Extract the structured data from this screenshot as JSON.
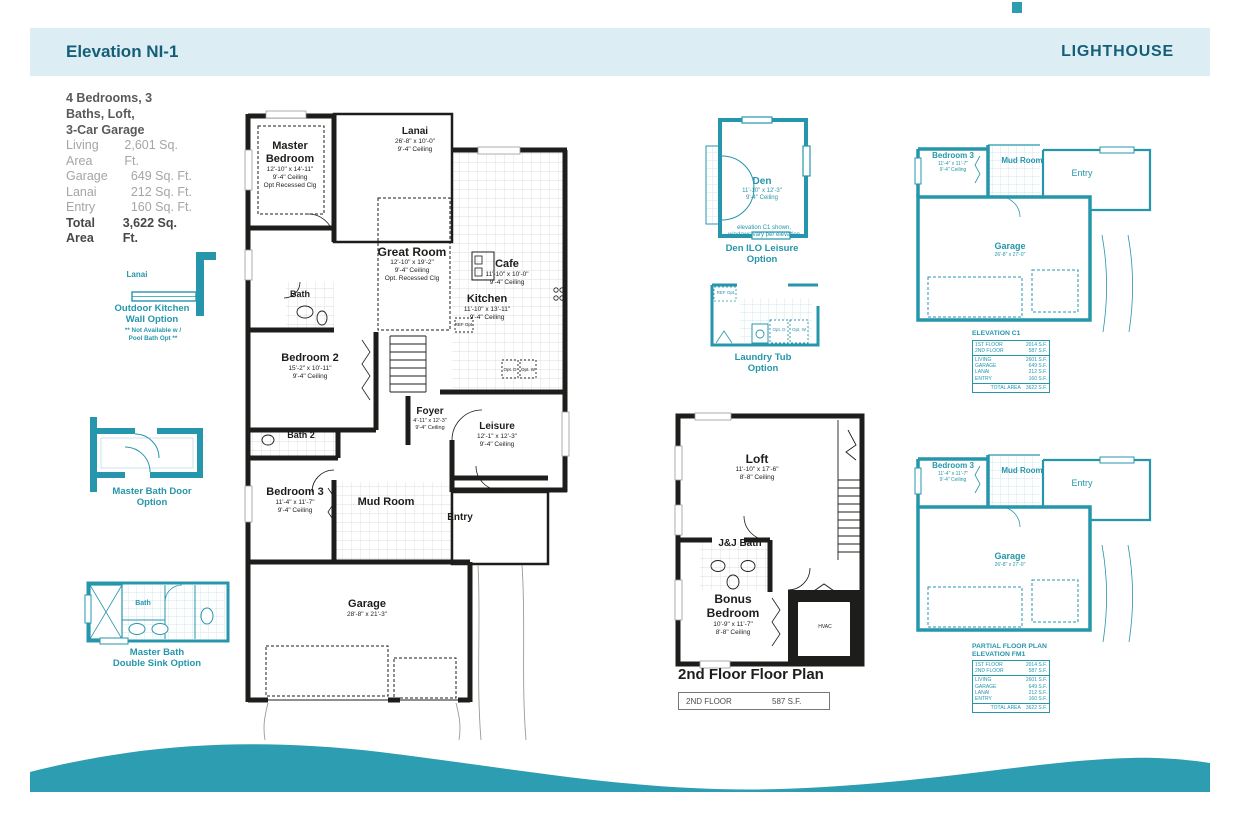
{
  "header": {
    "title": "Elevation NI-1",
    "brand": "LIGHTHOUSE"
  },
  "summary": {
    "line1": "4 Bedrooms, 3 Baths, Loft,",
    "line2": "3-Car Garage",
    "rows": [
      {
        "label": "Living Area",
        "value": "2,601 Sq. Ft."
      },
      {
        "label": "Garage",
        "value": "649 Sq. Ft."
      },
      {
        "label": "Lanai",
        "value": "212 Sq. Ft."
      },
      {
        "label": "Entry",
        "value": "160 Sq. Ft."
      },
      {
        "label": "Total Area",
        "value": "3,622 Sq. Ft."
      }
    ]
  },
  "first_floor": {
    "master_bedroom": {
      "name": "Master Bedroom",
      "dims": "12'-10\" x 14'-11\"",
      "ceiling": "9'-4\" Ceiling",
      "note": "Opt Recessed Clg"
    },
    "lanai": {
      "name": "Lanai",
      "dims": "26'-8\" x 10'-0\"",
      "ceiling": "9'-4\" Ceiling"
    },
    "cafe": {
      "name": "Cafe",
      "dims": "11'-10\" x 10'-0\"",
      "ceiling": "9'-4\" Ceiling"
    },
    "great_room": {
      "name": "Great Room",
      "dims": "12'-10\" x 19'-2\"",
      "ceiling": "9'-4\" Ceiling",
      "note": "Opt. Recessed Clg"
    },
    "kitchen": {
      "name": "Kitchen",
      "dims": "11'-10\" x 13'-11\"",
      "ceiling": "9'-4\" Ceiling"
    },
    "bath": {
      "name": "Bath"
    },
    "bedroom2": {
      "name": "Bedroom 2",
      "dims": "15'-2\" x 10'-11\"",
      "ceiling": "9'-4\" Ceiling"
    },
    "foyer": {
      "name": "Foyer",
      "dims": "4'-11\" x 12'-3\"",
      "ceiling": "9'-4\" Ceiling"
    },
    "leisure": {
      "name": "Leisure",
      "dims": "12'-1\" x 12'-3\"",
      "ceiling": "9'-4\" Ceiling"
    },
    "bath2": {
      "name": "Bath 2"
    },
    "bedroom3": {
      "name": "Bedroom 3",
      "dims": "11'-4\" x 11'-7\"",
      "ceiling": "9'-4\" Ceiling"
    },
    "mud_room": {
      "name": "Mud Room"
    },
    "entry": {
      "name": "Entry"
    },
    "garage": {
      "name": "Garage",
      "dims": "28'-8\" x 21'-3\""
    },
    "ref_label": "REF Opt.",
    "opt_d": "Opt. D",
    "opt_w": "Opt. W"
  },
  "options": {
    "outdoor_kitchen": {
      "room": "Lanai",
      "caption1": "Outdoor Kitchen",
      "caption2": "Wall Option",
      "note1": "** Not Available w /",
      "note2": "Pool Bath Opt **"
    },
    "master_bath_door": {
      "caption1": "Master Bath Door",
      "caption2": "Option"
    },
    "master_bath_sink": {
      "room": "Bath",
      "caption1": "Master Bath",
      "caption2": "Double Sink Option"
    },
    "den": {
      "name": "Den",
      "dims": "11'-10\" x 12'-3\"",
      "ceiling": "9'-4\" Ceiling",
      "note1": "elevation C1 shown,",
      "note2": "windows vary per elevation",
      "caption1": "Den ILO Leisure",
      "caption2": "Option"
    },
    "laundry": {
      "ref": "REF Opt.",
      "opt_d": "Opt. D",
      "opt_w": "Opt. W",
      "caption1": "Laundry Tub",
      "caption2": "Option"
    }
  },
  "second_floor": {
    "loft": {
      "name": "Loft",
      "dims": "11'-10\" x 17'-6\"",
      "ceiling": "8'-8\" Ceiling"
    },
    "jj_bath": {
      "name": "J&J Bath"
    },
    "bonus": {
      "name": "Bonus Bedroom",
      "dims": "10'-9\" x 11'-7\"",
      "ceiling": "8'-8\" Ceiling"
    },
    "hvac": "HVAC",
    "caption": "2nd Floor Floor Plan",
    "table": {
      "label": "2ND FLOOR",
      "value": "587  S.F."
    }
  },
  "elevation_c1": {
    "title": "ELEVATION C1",
    "bedroom3": {
      "name": "Bedroom 3",
      "dims": "11'-4\" x 11'-7\"",
      "ceiling": "9'-4\" Ceiling"
    },
    "mud_room": "Mud Room",
    "entry": "Entry",
    "garage": {
      "name": "Garage",
      "dims": "26'-8\" x 27'-0\""
    },
    "table": {
      "floors": [
        {
          "label": "1ST FLOOR",
          "value": "2014 S.F."
        },
        {
          "label": "2ND FLOOR",
          "value": "587 S.F."
        }
      ],
      "areas": [
        {
          "label": "LIVING",
          "value": "2601 S.F."
        },
        {
          "label": "GARAGE",
          "value": "649 S.F."
        },
        {
          "label": "LANAI",
          "value": "212 S.F."
        },
        {
          "label": "ENTRY",
          "value": "160 S.F."
        }
      ],
      "total": {
        "label": "TOTAL AREA",
        "value": "3622 S.F."
      }
    }
  },
  "elevation_fm1": {
    "title1": "PARTIAL FLOOR PLAN",
    "title2": "ELEVATION FM1",
    "bedroom3": {
      "name": "Bedroom 3",
      "dims": "11'-4\" x 11'-7\"",
      "ceiling": "9'-4\" Ceiling"
    },
    "mud_room": "Mud Room",
    "entry": "Entry",
    "garage": {
      "name": "Garage",
      "dims": "26'-8\" x 27'-0\""
    },
    "table": {
      "floors": [
        {
          "label": "1ST FLOOR",
          "value": "2014 S.F."
        },
        {
          "label": "2ND FLOOR",
          "value": "587 S.F."
        }
      ],
      "areas": [
        {
          "label": "LIVING",
          "value": "2601 S.F."
        },
        {
          "label": "GARAGE",
          "value": "649 S.F."
        },
        {
          "label": "LANAI",
          "value": "212 S.F."
        },
        {
          "label": "ENTRY",
          "value": "160 S.F."
        }
      ],
      "total": {
        "label": "TOTAL AREA",
        "value": "3622 S.F."
      }
    }
  },
  "colors": {
    "teal": "#2596ab",
    "wave": "#2d9db2",
    "band": "#dceef4",
    "header_text": "#155e78"
  }
}
